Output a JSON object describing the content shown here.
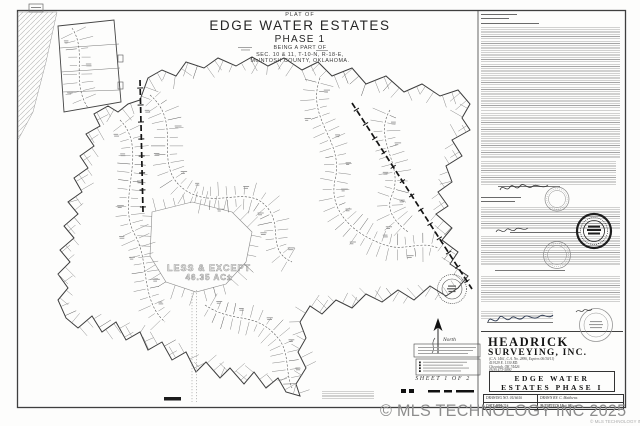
{
  "title_block": {
    "plat_of": "PLAT OF",
    "name": "EDGE WATER ESTATES",
    "phase": "PHASE 1",
    "being_a_part_of": "BEING A PART OF",
    "section_line": "SEC. 10 & 11, T-10-N, R-18-E,",
    "county_line": "McINTOSH COUNTY, OKLAHOMA."
  },
  "map": {
    "less_and_except_line1": "LESS & EXCEPT",
    "less_and_except_line2": "46.35 AC±",
    "north_label": "North",
    "sheet_label": "SHEET 1 OF 2"
  },
  "surveyor_block": {
    "firm_name_line1": "HEADRICK",
    "firm_name_line2": "SURVEYING, INC.",
    "license_line": "(C.A. 1461, C.A. No. 2886, Expires 06/30/11)",
    "address_line1": "419129 E. 1130 RD.",
    "address_line2": "Checotah, OK 74426",
    "phone": "(918) 473-5890",
    "project_line1": "EDGE WATER",
    "project_line2": "ESTATES PHASE I",
    "drawing_no_label": "DRAWING NO. 0116616",
    "drawn_by_label": "DRAWN BY: C. Matthews",
    "date_label": "DATE 5/24/11",
    "surveyed_label": "SURVEYED: Matt Wilson"
  },
  "watermark": {
    "main": "© MLS TECHNOLOGY INC 2025",
    "small": "© MLS TECHNOLOGY INC 2025"
  },
  "colors": {
    "ink": "#2e2e2e",
    "light_ink": "#8f8f8f",
    "watermark_gray": "#8d8d8d",
    "paper": "#fdfdfc"
  }
}
